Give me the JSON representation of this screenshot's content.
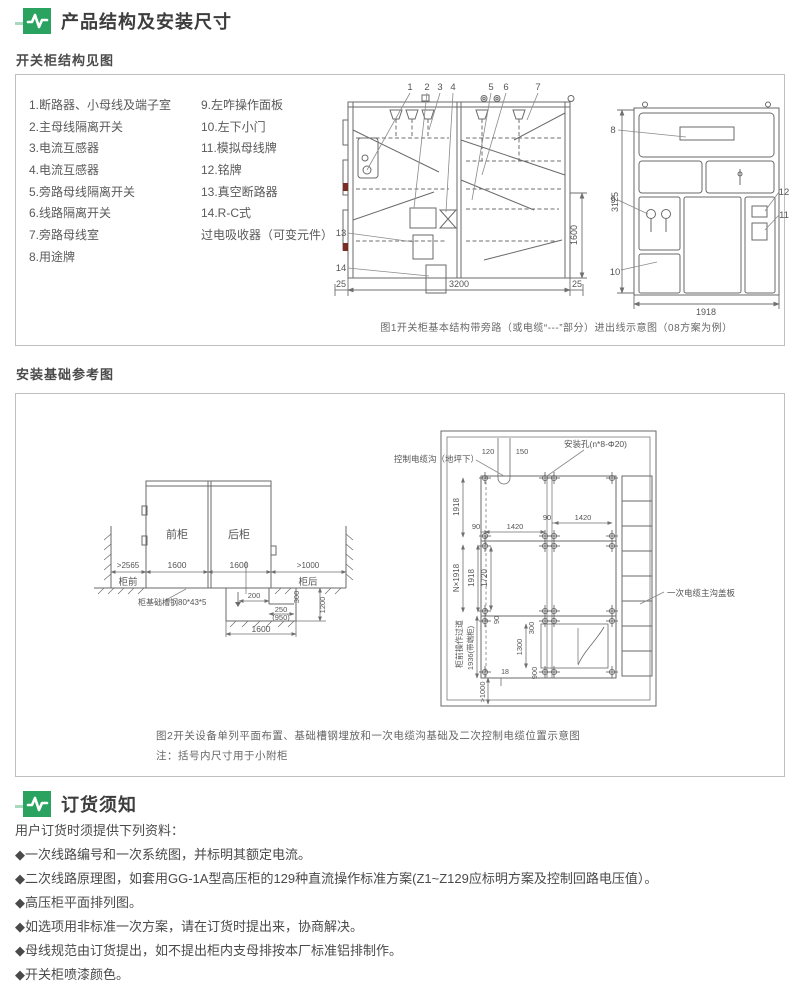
{
  "theme": {
    "green": "#2aa360",
    "green_light": "#a9d8bd",
    "line": "#6a6a6a",
    "border": "#bfbfbf"
  },
  "section1": {
    "title": "产品结构及安装尺寸",
    "subtitle": "开关柜结构见图",
    "parts_left": [
      "1.断路器、小母线及端子室",
      "2.主母线隔离开关",
      "3.电流互感器",
      "4.电流互感器",
      "5.旁路母线隔离开关",
      "6.线路隔离开关",
      "7.旁路母线室",
      "8.用途牌"
    ],
    "parts_right": [
      "9.左咋操作面板",
      "10.左下小门",
      "11.模拟母线牌",
      "12.铭牌",
      "13.真空断路器",
      "14.R-C式",
      "过电吸收器（可变元件）"
    ]
  },
  "figure1": {
    "caption": "图1开关柜基本结构带旁路（或电缆“---”部分）进出线示意图（08方案为例）",
    "callouts": {
      "c1": "1",
      "c2": "2",
      "c3": "3",
      "c4": "4",
      "c5": "5",
      "c6": "6",
      "c7": "7",
      "c8": "8",
      "c9": "9",
      "c10": "10",
      "c11": "11",
      "c12": "12",
      "c13": "13",
      "c14": "14"
    },
    "dims": {
      "left_margin": "25",
      "width": "3200",
      "right_margin": "25",
      "height_lower": "1600",
      "front_height": "3125",
      "front_width": "1918"
    }
  },
  "section2": {
    "title": "安装基础参考图"
  },
  "figure2": {
    "caption": "图2开关设备单列平面布置、基础槽钢埋放和一次电缆沟基础及二次控制电缆位置示意图",
    "note": "注：括号内尺寸用于小附柜",
    "section_view": {
      "front_cabinet": "前柜",
      "rear_cabinet": "后柜",
      "front_clearance": ">2565",
      "front_label": "柜前",
      "rear_clearance": ">1000",
      "rear_label": "柜后",
      "width1": "1600",
      "width2": "1600",
      "channel_label": "柜基础槽钢80*43*5",
      "pit_200": "200",
      "pit_250": "250",
      "pit_950": "(950)",
      "pit_300": "300",
      "pit_1200": "1200",
      "pit_1600": "1600"
    },
    "plan_view": {
      "hole_label": "安装孔(n*8-Φ20)",
      "ctrl_trench_label": "控制电缆沟（地坪下）",
      "d120": "120",
      "d150": "150",
      "depth1": "1918",
      "h90a": "90",
      "h1420a": "1420",
      "h90b": "90",
      "h1420b": "1420",
      "n_depth": "N×1918",
      "depth2": "1918",
      "inner1720": "1720",
      "v90": "90",
      "t300": "300",
      "t1300": "1300",
      "t900": "900",
      "t18": "18",
      "rear_min": ">1000",
      "end_cab": "1936(带端柜)",
      "aisle": "柜前操作过道",
      "cover_label": "一次电缆主沟盖板"
    }
  },
  "section3": {
    "title": "订货须知",
    "intro": "用户订货时须提供下列资料：",
    "bullets": [
      "◆一次线路编号和一次系统图，并标明其额定电流。",
      "◆二次线路原理图，如套用GG-1A型高压柜的129种直流操作标准方案(Z1~Z129应标明方案及控制回路电压值）。",
      "◆高压柜平面排列图。",
      "◆如选项用非标准一次方案，请在订货时提出来，协商解决。",
      "◆母线规范由订货提出，如不提出柜内支母排按本厂标准铝排制作。",
      "◆开关柜喷漆颜色。"
    ]
  }
}
